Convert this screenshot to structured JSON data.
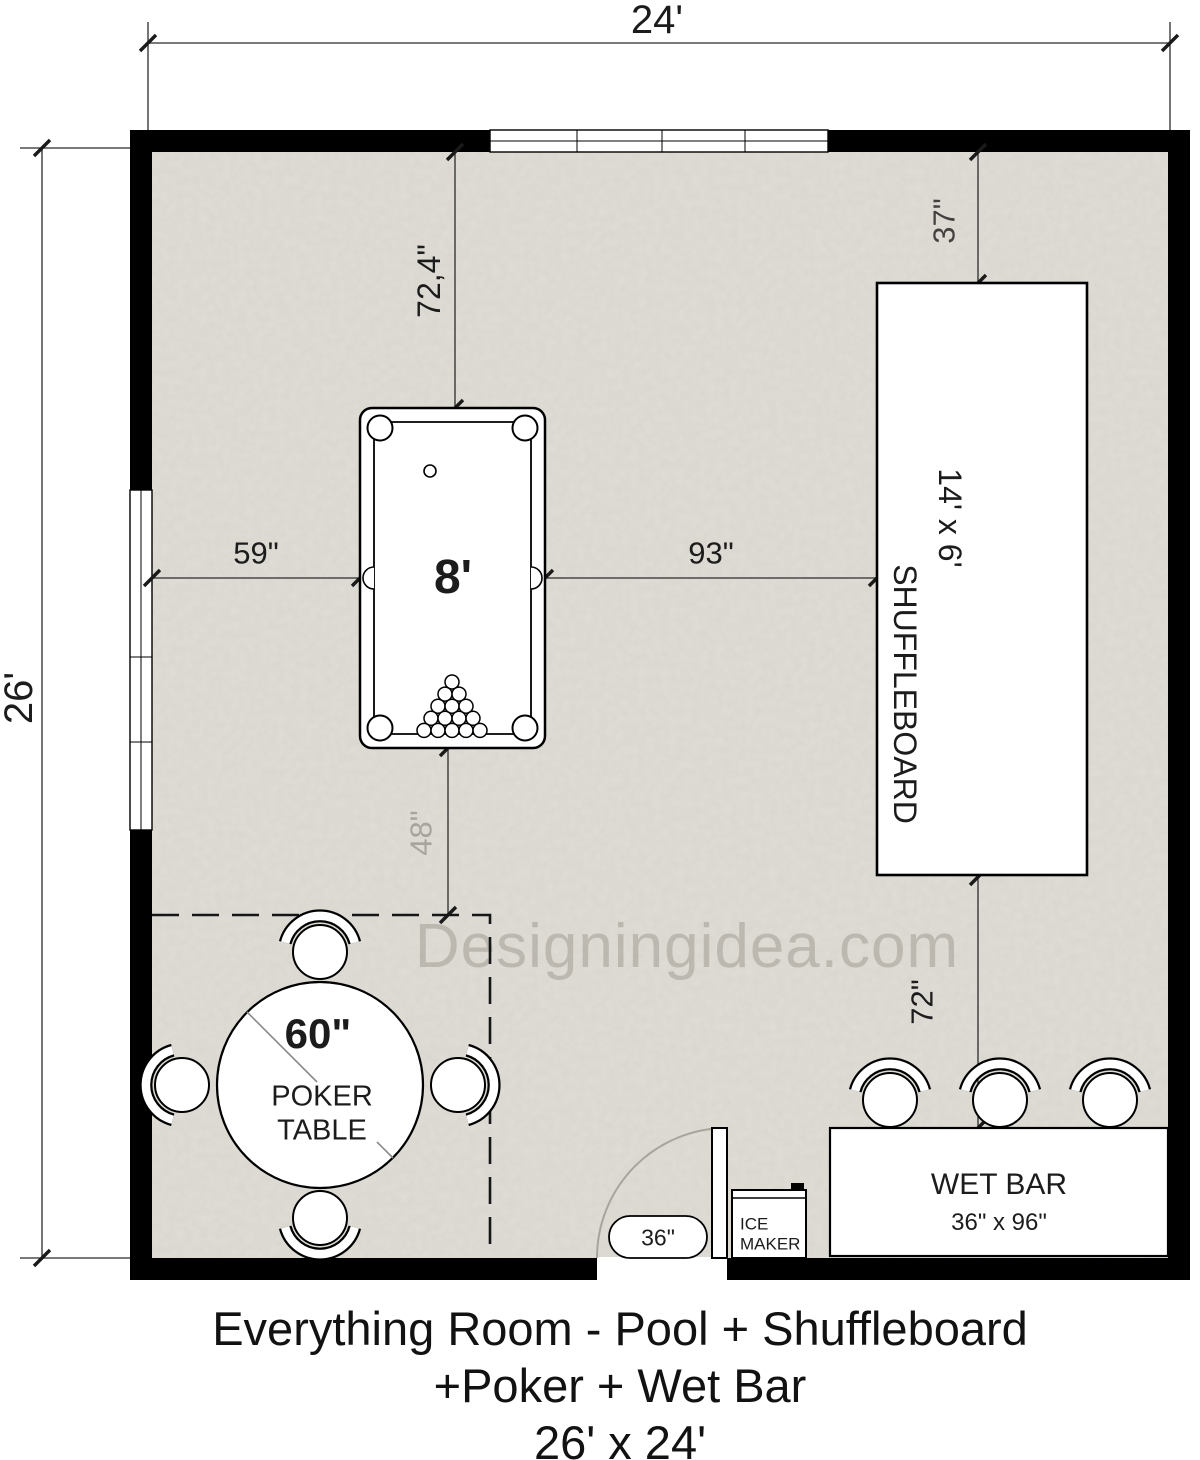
{
  "title": {
    "line1": "Everything Room - Pool + Shuffleboard",
    "line2": "+Poker + Wet Bar",
    "line3": "26' x 24'"
  },
  "watermark": "Designingidea.com",
  "room": {
    "width_label": "24'",
    "height_label": "26'"
  },
  "pool_table": {
    "size": "8'",
    "dim_top": "72,4\"",
    "dim_left": "59\"",
    "dim_right": "93\"",
    "dim_bottom": "48\""
  },
  "shuffleboard": {
    "size": "14' x 6'",
    "name": "SHUFFLEBOARD",
    "dim_top": "37\"",
    "dim_bottom": "72\""
  },
  "poker": {
    "diameter": "60\"",
    "name_line1": "POKER",
    "name_line2": "TABLE"
  },
  "wet_bar": {
    "name": "WET BAR",
    "size": "36\" x 96\""
  },
  "ice_maker": {
    "line1": "ICE",
    "line2": "MAKER"
  },
  "door": {
    "width": "36\""
  },
  "colors": {
    "wall": "#000000",
    "floor": "#e0ddd6",
    "dimension_line": "#2b2b2b",
    "watermark": "#8c867c"
  }
}
